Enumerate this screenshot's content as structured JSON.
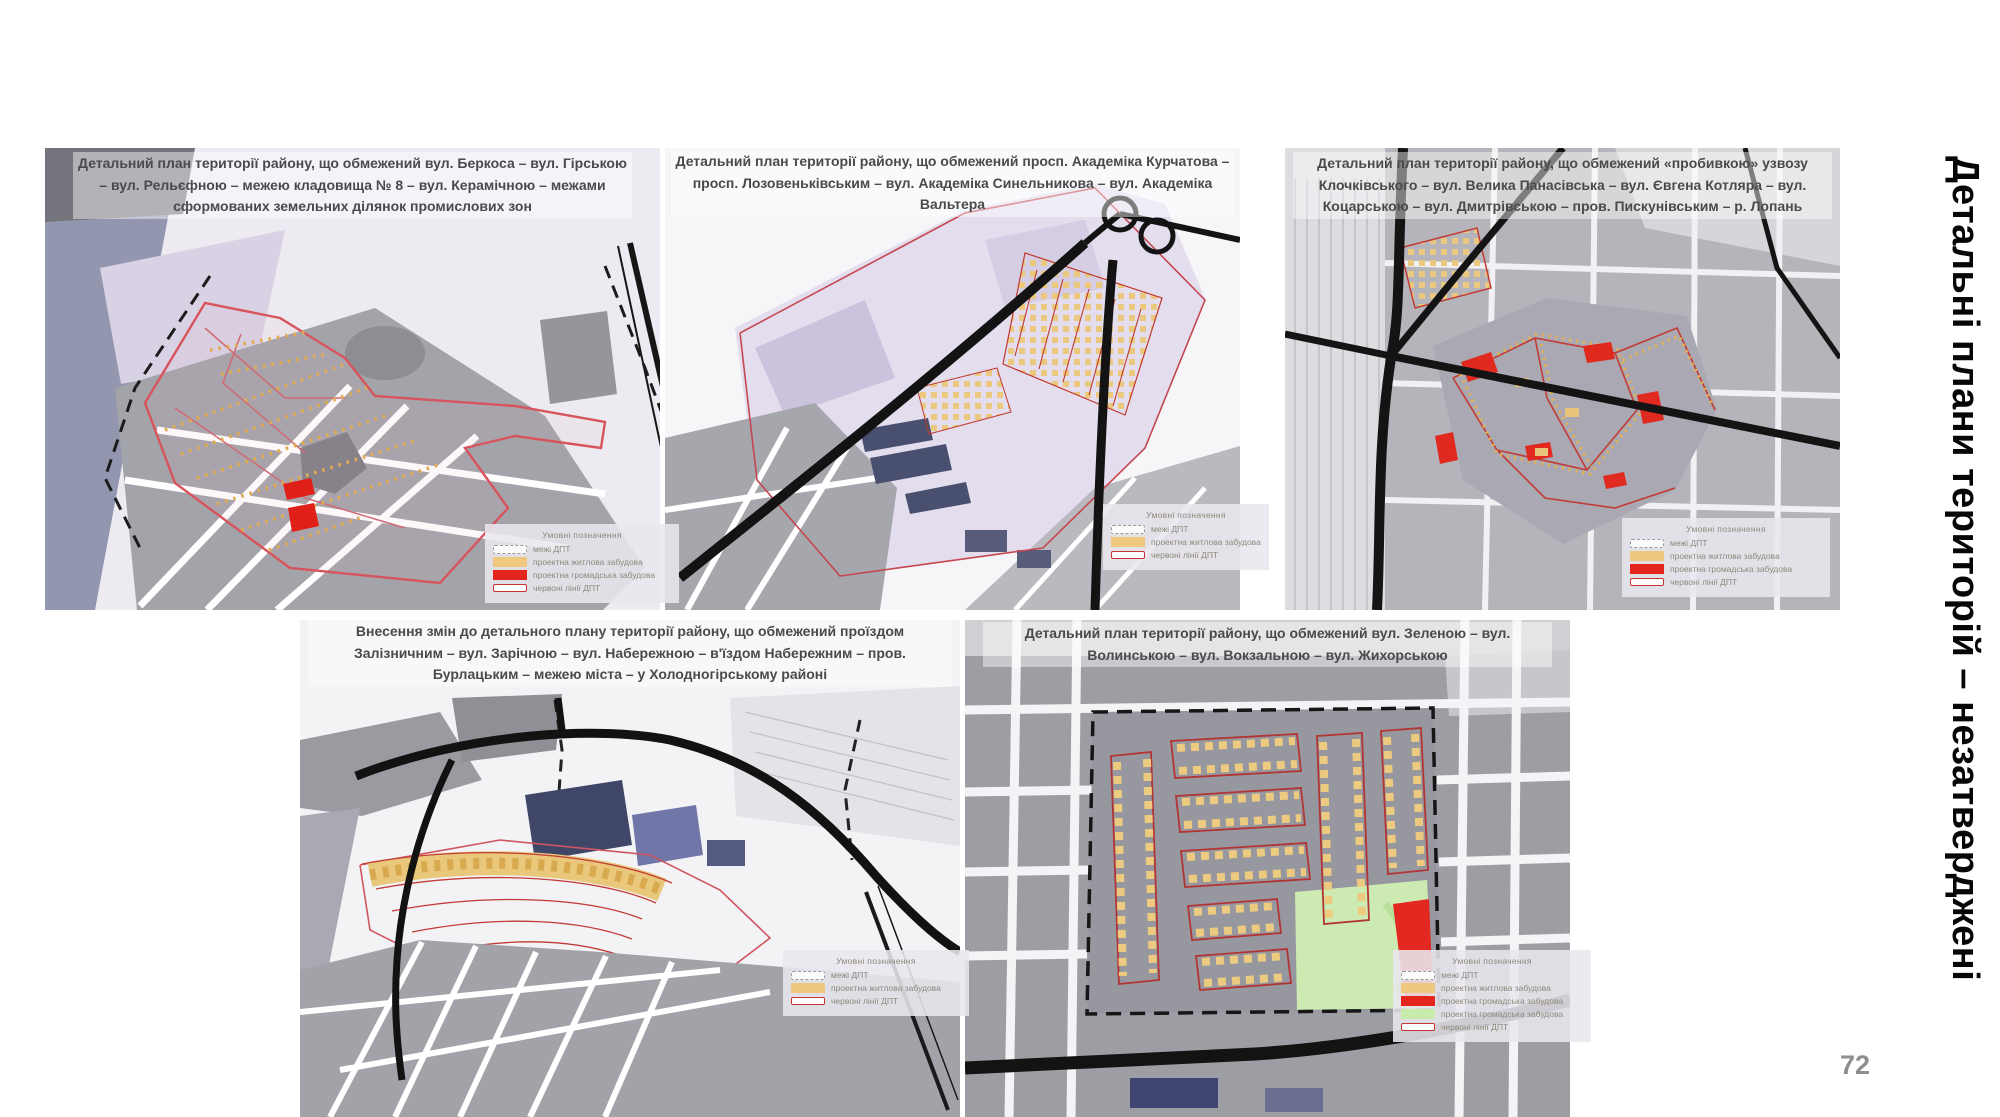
{
  "slide": {
    "vertical_title": "Детальні плани територій – незатверджені",
    "page_number": "72"
  },
  "colors": {
    "residential": "#eec87e",
    "public": "#e3261d",
    "green": "#c9ecad",
    "redline": "#c53333",
    "plan_boundary_red": "#d8545c",
    "road_black": "#141414"
  },
  "maps": [
    {
      "title": "Детальний план території району, що обмежений вул. Беркоса – вул. Гірською – вул. Рельєфною – межею кладовища № 8 – вул. Керамічною – межами сформованих земельних ділянок промислових зон",
      "legend": {
        "header": "Умовні позначення",
        "items": [
          {
            "swatch": "dashed",
            "label": "межі ДПТ"
          },
          {
            "swatch": "residential",
            "label": "проектна житлова забудова"
          },
          {
            "swatch": "public",
            "label": "проектна громадська забудова"
          },
          {
            "swatch": "redline",
            "label": "червоні лінії ДПТ"
          }
        ]
      }
    },
    {
      "title": "Детальний план території району, що обмежений просп. Академіка Курчатова – просп. Лозовеньківським – вул. Академіка Синельникова – вул. Академіка Вальтера",
      "legend": {
        "header": "Умовні позначення",
        "items": [
          {
            "swatch": "dashed",
            "label": "межі ДПТ"
          },
          {
            "swatch": "residential",
            "label": "проектна житлова забудова"
          },
          {
            "swatch": "redline",
            "label": "червоні лінії ДПТ"
          }
        ]
      }
    },
    {
      "title": "Детальний план території району, що обмежений «пробивкою» узвозу Клочківського – вул. Велика Панасівська – вул. Євгена Котляра – вул. Коцарською – вул. Дмитрівською – пров. Пискунівським – р. Лопань",
      "legend": {
        "header": "Умовні позначення",
        "items": [
          {
            "swatch": "dashed",
            "label": "межі ДПТ"
          },
          {
            "swatch": "residential",
            "label": "проектна житлова забудова"
          },
          {
            "swatch": "public",
            "label": "проектна громадська забудова"
          },
          {
            "swatch": "redline",
            "label": "червоні лінії ДПТ"
          }
        ]
      }
    },
    {
      "title": "Внесення змін до детального плану території району, що обмежений проїздом Залізничним – вул. Зарічною – вул. Набережною – в'їздом Набережним – пров. Бурлацьким – межею міста – у Холодногірському районі",
      "legend": {
        "header": "Умовні позначення",
        "items": [
          {
            "swatch": "dashed",
            "label": "межі ДПТ"
          },
          {
            "swatch": "residential",
            "label": "проектна житлова забудова"
          },
          {
            "swatch": "redline",
            "label": "червоні лінії ДПТ"
          }
        ]
      }
    },
    {
      "title": "Детальний план території району, що обмежений вул. Зеленою –  вул. Волинською – вул. Вокзальною – вул. Жихорською",
      "legend": {
        "header": "Умовні позначення",
        "items": [
          {
            "swatch": "dashed",
            "label": "межі ДПТ"
          },
          {
            "swatch": "residential",
            "label": "проектна житлова забудова"
          },
          {
            "swatch": "public",
            "label": "проектна громадська забудова"
          },
          {
            "swatch": "green",
            "label": "проектна громадська забудова"
          },
          {
            "swatch": "redline",
            "label": "червоні лінії ДПТ"
          }
        ]
      }
    }
  ]
}
